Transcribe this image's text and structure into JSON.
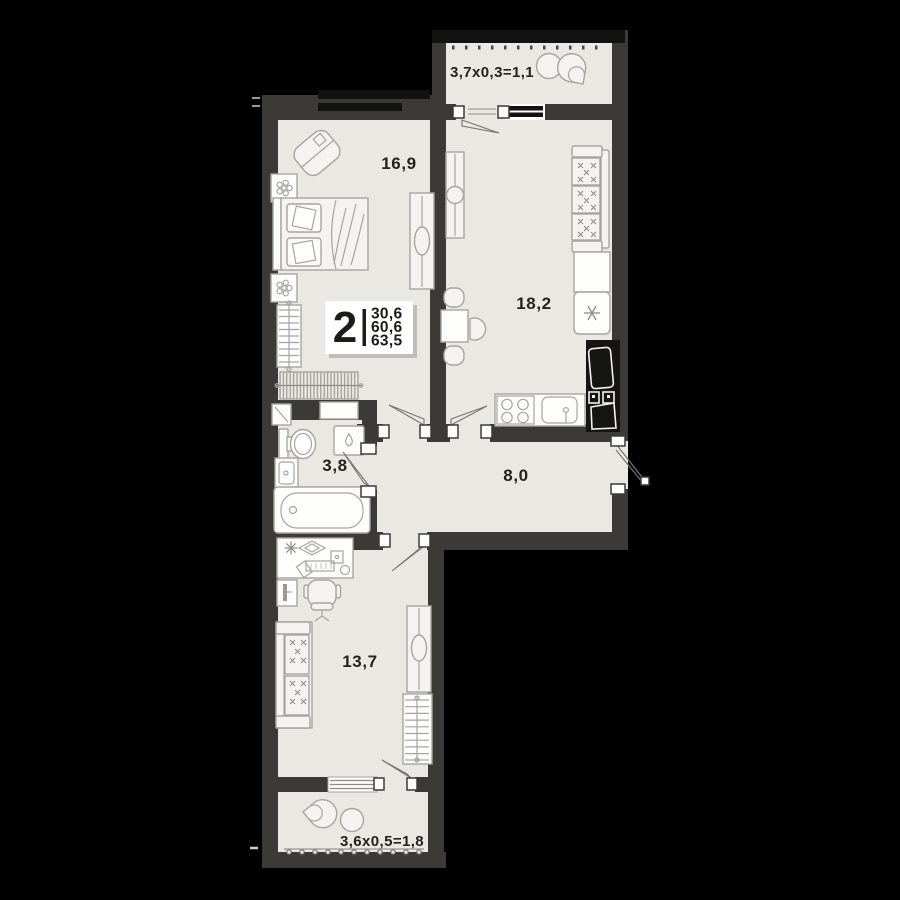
{
  "unit_tag": {
    "rooms_count": "2",
    "values": [
      "30,6",
      "60,6",
      "63,5"
    ]
  },
  "room_labels": {
    "bedroom": "16,9",
    "kitchen_living": "18,2",
    "bathroom": "3,8",
    "hallway": "8,0",
    "bedroom2": "13,7",
    "balcony_top": "3,7x0,3=1,1",
    "balcony_bottom": "3,6x0,5=1,8"
  },
  "colors": {
    "background": "#000000",
    "wall": "#3b3a37",
    "wall_dark": "#121212",
    "floor": "#e9e8e3",
    "furniture_stroke": "#a6a5a0",
    "text": "#24231f",
    "tag_background": "#ffffff"
  }
}
